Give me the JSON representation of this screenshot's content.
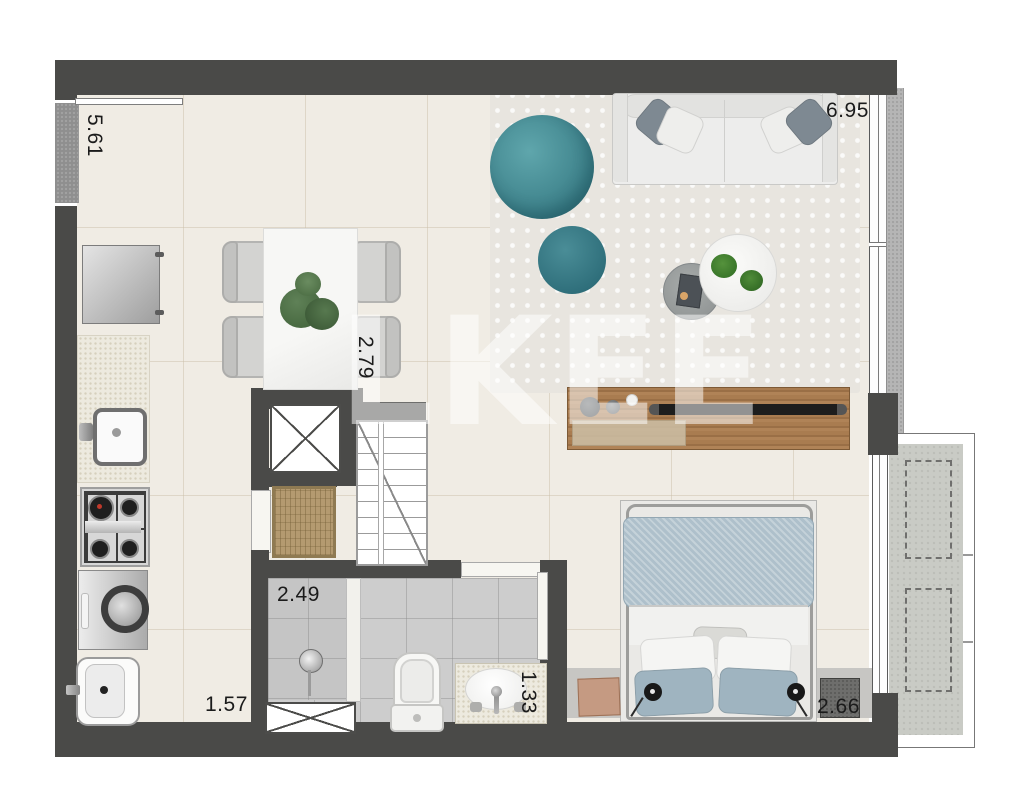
{
  "watermark": {
    "text": "LKEE"
  },
  "dimensions": {
    "left_window": "5.61",
    "living_width": "6.95",
    "hall_depth": "2.79",
    "shower_width": "2.49",
    "service_width": "1.57",
    "bathroom_width": "1.33",
    "bedroom_width": "2.66"
  },
  "colors": {
    "wall": "#4a4a48",
    "floor": "#f0ece4",
    "rug": "#e8e5df",
    "bath_floor": "#cdcdcd",
    "balcony_floor": "#c9cbc5",
    "teal_ottoman_large": "#4f9aa3",
    "teal_ottoman_small": "#3d7f8a",
    "wood_console": "#a97c50",
    "bed_duvet": "#aec0cb",
    "doormat": "#b49a70",
    "dimension_text": "#1b1b1b"
  },
  "fixtures": [
    "sofa",
    "throw-pillows",
    "ottoman-large",
    "ottoman-small",
    "coffee-table",
    "side-table",
    "tv-console",
    "soundbar",
    "dining-table",
    "dining-chairs",
    "table-plant",
    "refrigerator",
    "kitchen-counter",
    "kitchen-sink",
    "cooktop",
    "washing-machine",
    "laundry-tank",
    "elevator-shaft",
    "staircase",
    "doormat",
    "entry-door",
    "shower",
    "shower-drain",
    "toilet",
    "vanity-sink",
    "double-bed",
    "pillows",
    "nightstand-left",
    "nightstand-right",
    "reading-lamps",
    "balcony",
    "window-left",
    "window-right",
    "duct-shaft"
  ]
}
